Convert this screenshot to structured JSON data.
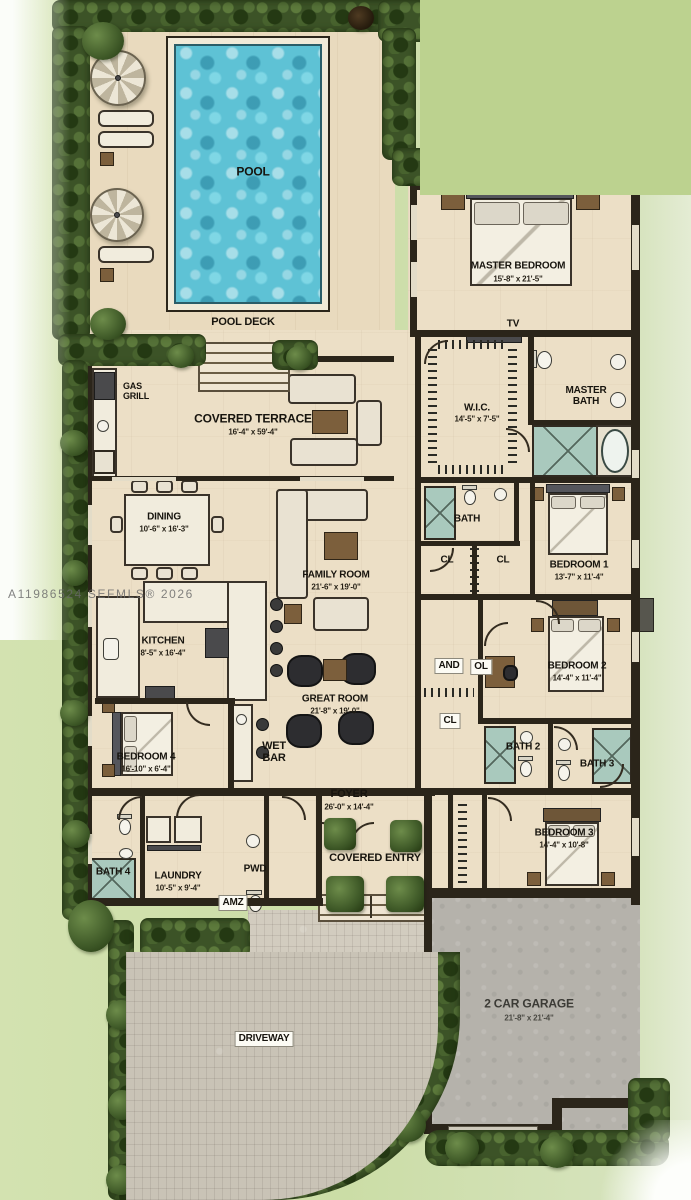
{
  "watermark": "A11986524 SEFMLS® 2026",
  "rooms": {
    "pool": {
      "name": "POOL"
    },
    "pool_deck": {
      "name": "POOL DECK"
    },
    "master_bedroom": {
      "name": "MASTER BEDROOM",
      "dims": "15'-8\" x 21'-5\""
    },
    "tv": {
      "name": "TV"
    },
    "gas_grill": {
      "name": "GAS\nGRILL"
    },
    "covered_terrace": {
      "name": "COVERED TERRACE",
      "dims": "16'-4\" x 59'-4\""
    },
    "wic": {
      "name": "W.I.C.",
      "dims": "14'-5\" x 7'-5\""
    },
    "master_bath": {
      "name": "MASTER\nBATH"
    },
    "bath": {
      "name": "BATH"
    },
    "cl_a": {
      "name": "CL"
    },
    "cl_b": {
      "name": "CL"
    },
    "bedroom1": {
      "name": "BEDROOM 1",
      "dims": "13'-7\" x 11'-4\""
    },
    "dining": {
      "name": "DINING",
      "dims": "10'-6\" x 16'-3\""
    },
    "family_room": {
      "name": "FAMILY ROOM",
      "dims": "21'-6\" x 19'-0\""
    },
    "kitchen": {
      "name": "KITCHEN",
      "dims": "8'-5\" x 16'-4\""
    },
    "bedroom2": {
      "name": "BEDROOM 2",
      "dims": "14'-4\" x 11'-4\""
    },
    "and_closet": {
      "name": "AND"
    },
    "ol_closet": {
      "name": "OL"
    },
    "great_room": {
      "name": "GREAT ROOM",
      "dims": "21'-8\" x 19'-0\""
    },
    "cl_hall": {
      "name": "CL"
    },
    "bedroom4": {
      "name": "BEDROOM 4",
      "dims": "16'-10\" x 6'-4\""
    },
    "wet_bar": {
      "name": "WET\nBAR"
    },
    "bath2": {
      "name": "BATH 2"
    },
    "bath3": {
      "name": "BATH 3"
    },
    "foyer": {
      "name": "FOYER",
      "dims": "26'-0\" x 14'-4\""
    },
    "bedroom3": {
      "name": "BEDROOM 3",
      "dims": "14'-4\" x 10'-8\""
    },
    "bath4": {
      "name": "BATH 4"
    },
    "laundry": {
      "name": "LAUNDRY",
      "dims": "10'-5\" x 9'-4\""
    },
    "pwd": {
      "name": "PWD"
    },
    "amz": {
      "name": "AMZ"
    },
    "covered_entry": {
      "name": "COVERED ENTRY"
    },
    "garage": {
      "name": "2 CAR GARAGE",
      "dims": "21'-8\" x 21'-4\""
    },
    "driveway": {
      "name": "DRIVEWAY"
    }
  },
  "colors": {
    "grass": "#cbdda6",
    "hedge": "#3c5327",
    "floor": "#ecdfc6",
    "wall": "#2b251a",
    "pool": "#5ec2d5",
    "garage": "#b5b2ab",
    "driveway": "#c9c3b6"
  }
}
